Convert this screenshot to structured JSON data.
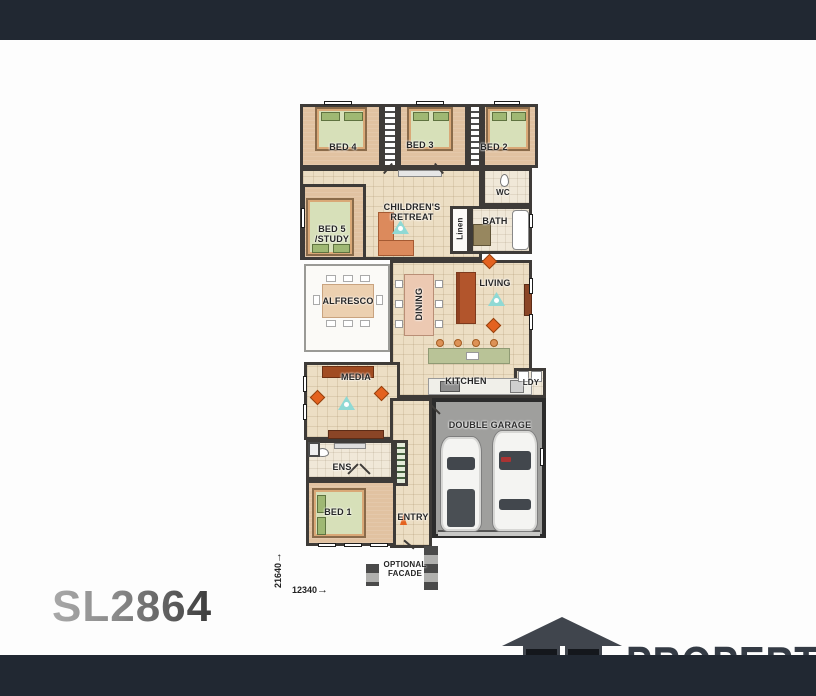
{
  "plan": {
    "code": "SL2864",
    "rooms": {
      "bed4": "BED 4",
      "bed3": "BED 3",
      "bed2": "BED 2",
      "retreat": "CHILDREN'S RETREAT",
      "bed5": "BED 5 /STUDY",
      "linen": "Linen",
      "wc": "WC",
      "bath": "BATH",
      "living": "LIVING",
      "alfresco": "ALFRESCO",
      "dining": "DINING",
      "media": "MEDIA",
      "kitchen": "KITCHEN",
      "ldy": "LDY",
      "ens": "ENS",
      "bed1": "BED 1",
      "entry": "ENTRY",
      "garage": "DOUBLE GARAGE"
    },
    "annotations": {
      "optional_facade": "OPTIONAL FACADE",
      "dim_vertical": "21640",
      "dim_horizontal": "12340",
      "arrow_right": "→"
    }
  },
  "footer": {
    "logo_letter_j": "J",
    "logo_letter_l": "L",
    "brand": "PROPERTY"
  },
  "colors": {
    "bar": "#212832",
    "wall": "#3e3b38",
    "floor_tile": "#ecdec4",
    "carpet": "#e1c2a1",
    "garage_floor": "#9f9f9d",
    "bed_green": "#d7e0b9",
    "accent_orange": "#e4621f",
    "fan_teal": "#8fd9d4",
    "logo_gray": "#40454d"
  }
}
